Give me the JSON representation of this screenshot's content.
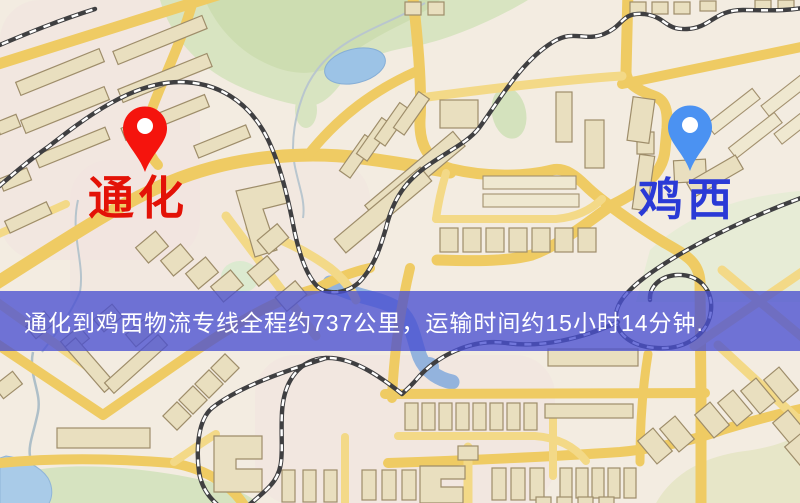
{
  "map": {
    "origin": {
      "name": "通化",
      "label_color": "#e31207",
      "marker_color": "#f5140d"
    },
    "destination": {
      "name": "鸡西",
      "label_color": "#2a3ad6",
      "marker_color": "#4b92f2"
    }
  },
  "banner": {
    "text": "通化到鸡西物流专线全程约737公里，运输时间约15小时14分钟.",
    "background": "rgba(73,79,209,0.78)",
    "text_color": "#ffffff",
    "route": {
      "from": "通化",
      "to": "鸡西",
      "distance": "约737公里",
      "duration": "约15小时14分钟"
    }
  }
}
